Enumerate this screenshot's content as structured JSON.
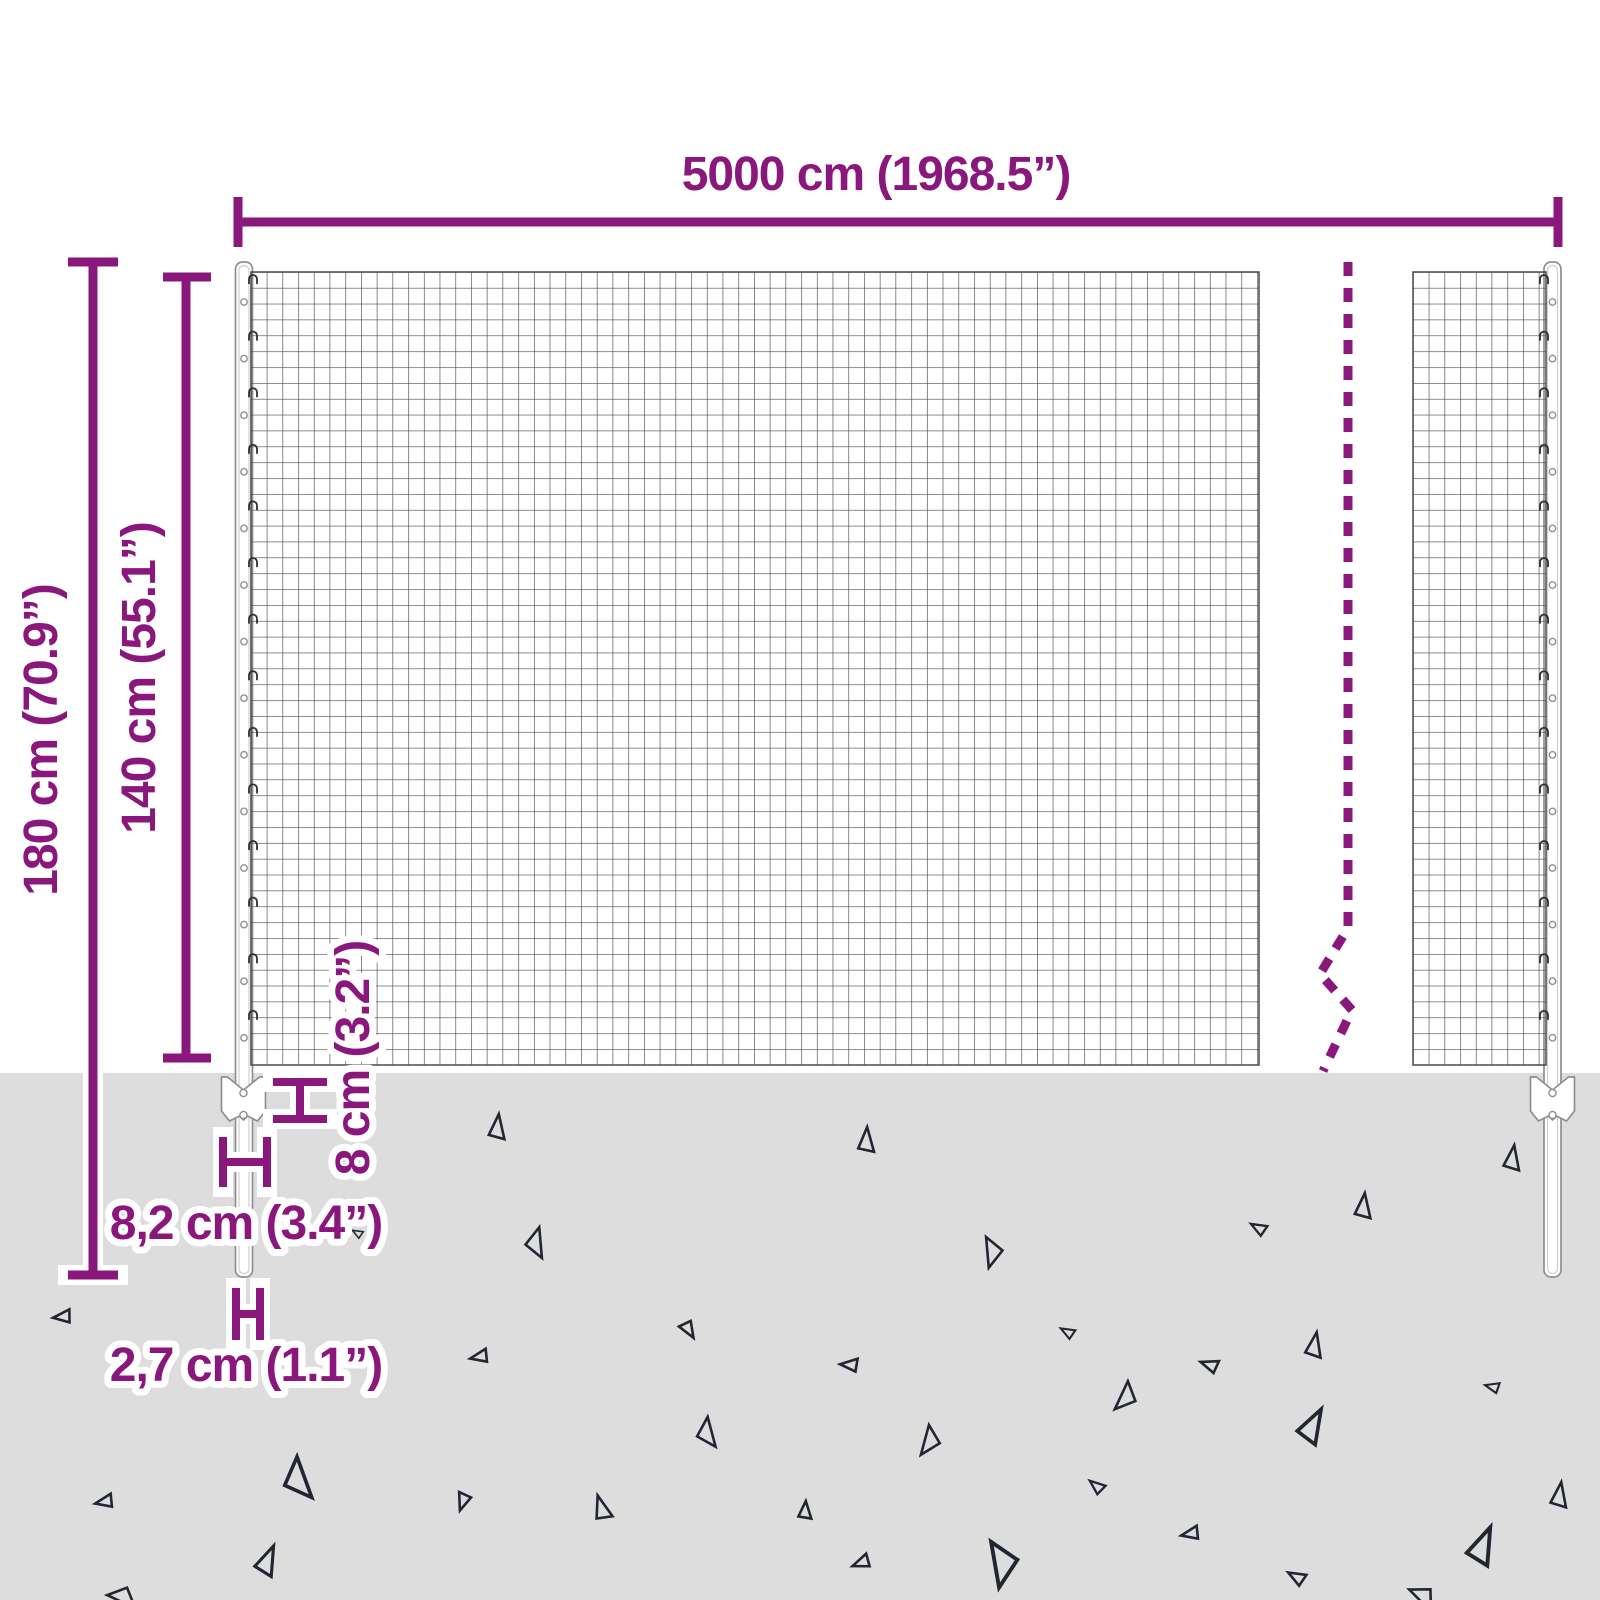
{
  "labels": {
    "width": "5000 cm (1968.5”)",
    "total_height": "180 cm (70.9”)",
    "panel_height": "140 cm (55.1”)",
    "anchor_height": "8 cm (3.2”)",
    "anchor_width": "8,2 cm (3.4”)",
    "post_diameter": "2,7 cm (1.1”)"
  },
  "colors": {
    "dimension_accent": "#8a177c",
    "ground": "#dddddd",
    "mesh_line": "#4a4a4a"
  }
}
